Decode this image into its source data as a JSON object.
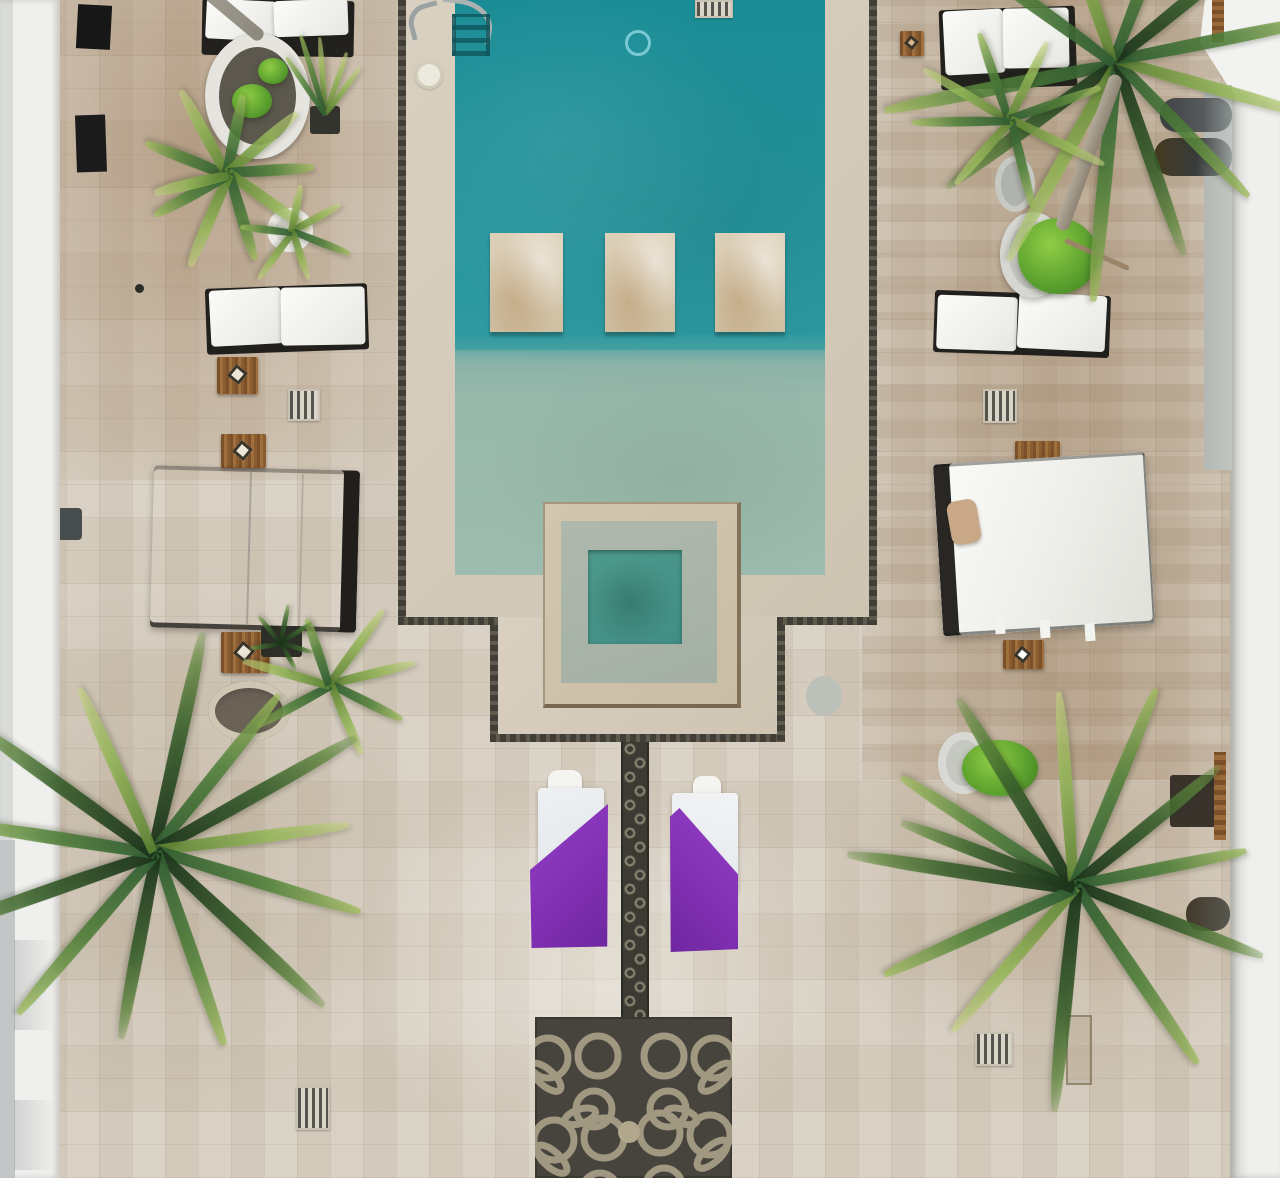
{
  "scene": {
    "description": "Aerial top-down drone photograph of a resort courtyard: a turquoise swimming pool with three submerged stone lounger slabs and an attached square spa, surrounded by a beige travertine tile deck with white lounge chairs, two white daybeds, a white patio umbrella, potted palms and plants, two loungers draped with purple towels, a dark mosaic walkway strip and an ornamental dark mosaic rug, bounded by white walls on the left and right.",
    "objects": {
      "pool": "swimming pool",
      "pool_deep": "deep end water",
      "pool_shallow": "shallow shelf water",
      "slabs": "in-pool stone lounging slabs",
      "spa": "square spa / plunge basin",
      "ladder": "chrome pool ladder",
      "pool_light": "pool light",
      "umbrella": "white patio umbrella",
      "daybed_left": "white draped daybed",
      "daybed_right": "white canopy daybed",
      "lounger": "lounge chair with white cushion",
      "purple_lounger": "lounger with purple towel",
      "walkway": "mosaic walkway strip",
      "rug": "ornamental mosaic rug",
      "fountain": "round stone fountain",
      "palm": "palm tree",
      "side_table": "wooden side table",
      "drain": "deck drain grate",
      "wall_left": "white wall (left)",
      "wall_right": "white wall (right)"
    },
    "counts": {
      "lounge_chairs": 4,
      "daybeds": 2,
      "purple_towel_loungers": 2,
      "umbrellas": 1,
      "palm_trees": 6,
      "in_pool_slabs": 3
    }
  },
  "palette": {
    "deck-base": "#d6cec0",
    "pool-deep-a": "#1a8c95",
    "pool-deep-b": "#2f9aa1",
    "pool-shallow": "#97b8ab",
    "spa-frame": "#c9bda6",
    "spa-shelf": "#a5b0a4",
    "spa-water": "#418e85",
    "stone-coping": "#d3cabb",
    "border-dark": "#44423a",
    "wall-white": "#efefed",
    "wall-gray": "#c2c6c6",
    "cushion-white": "#f5f5f3",
    "frame-dark": "#23221f",
    "towel-purple": "#8230b4",
    "towel-cushion": "#dfe4ea",
    "pillow-tan": "#c9a887",
    "wood-table": "#8a5c30",
    "rug-dark": "#46443d",
    "rug-loop": "#b1a78d",
    "palm-dark": "#2f5c31",
    "palm-mid": "#53823b",
    "palm-light": "#a3c05e",
    "bush-green": "#5aa02e",
    "chrome": "#9aa2a2"
  }
}
